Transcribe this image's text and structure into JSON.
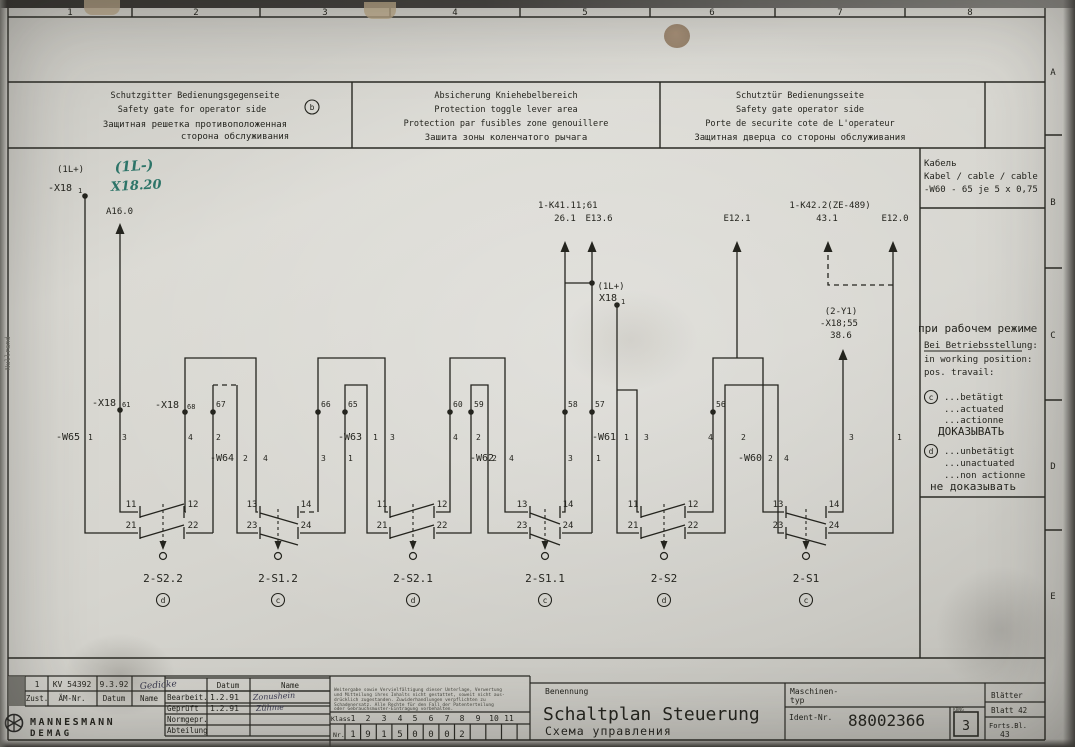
{
  "frame": {
    "ruler": [
      "1",
      "2",
      "3",
      "4",
      "5",
      "6",
      "7",
      "8"
    ],
    "rows": [
      "A",
      "B",
      "C",
      "D",
      "E"
    ],
    "margin_note": "Nullrand"
  },
  "header_boxes": [
    {
      "lines": [
        "Schutzgitter Bedienungsgegenseite",
        "Safety gate for operator side",
        "Защитная решетка противоположенная",
        "сторона обслуживания"
      ],
      "badge": "b"
    },
    {
      "lines": [
        "Absicherung Kniehebelbereich",
        "Protection toggle lever area",
        "Protection par fusibles zone genouillere",
        "Зашита зоны коленчатого рычага"
      ]
    },
    {
      "lines": [
        "Schutztür Bedienungsseite",
        "Safety gate operator side",
        "Porte de securite cote de L'operateur",
        "Защитная дверца со стороны обслуживания"
      ]
    }
  ],
  "cable_note": {
    "ru": "Кабель",
    "multi": "Kabel / cable / cable",
    "spec": "-W60 - 65 je 5 x 0,75"
  },
  "legend": {
    "title_ru": "при рабочем режиме",
    "title_de": "Bei Betriebsstellung:",
    "title_en": "in working position:",
    "title_fr": "pos. travail:",
    "c": {
      "sym": "c",
      "lines": [
        "...betätigt",
        "...actuated",
        "...actionne"
      ],
      "ru": "ДОКАЗЫВАТЬ"
    },
    "d": {
      "sym": "d",
      "lines": [
        "...unbetätigt",
        "...unactuated",
        "...non actionne"
      ],
      "ru": "не доказывать"
    }
  },
  "handwritten": {
    "l1": "(1L-)",
    "l2": "X18.20"
  },
  "sources": {
    "sup1_l1": "(1L+)",
    "sup1_l2": "-X18",
    "sup1_sub": "1",
    "a16": "A16.0",
    "k41_l1": "1-K41.11;61",
    "k41_l2": "26.1",
    "e13": "E13.6",
    "mid_l1": "(1L+)",
    "mid_l2": "X18",
    "mid_sub": "1",
    "e12_1": "E12.1",
    "k42_l1": "1-K42.2(ZE-489)",
    "k42_l2": "43.1",
    "e12_0": "E12.0",
    "y1_l1": "(2-Y1)",
    "y1_l2": "-X18;55",
    "y1_l3": "38.6"
  },
  "terminals": {
    "t61_label": "-X18",
    "t61_sub": "61",
    "t68_label": "-X18",
    "t68_sub": "68",
    "t67": "67",
    "t66": "66",
    "t65": "65",
    "t60": "60",
    "t59": "59",
    "t58": "58",
    "t57": "57",
    "t56": "56"
  },
  "cables": {
    "w65": {
      "name": "-W65",
      "c1": "1",
      "c2": "3",
      "c3": "4",
      "c4": "2"
    },
    "w64": {
      "name": "-W64",
      "c1": "2",
      "c2": "4",
      "c3": "3",
      "c4": "1"
    },
    "w63": {
      "name": "-W63",
      "c1": "1",
      "c2": "3",
      "c3": "4",
      "c4": "2"
    },
    "w62": {
      "name": "-W62",
      "c1": "2",
      "c2": "4",
      "c3": "3",
      "c4": "1"
    },
    "w61": {
      "name": "-W61",
      "c1": "1",
      "c2": "3",
      "c3": "4",
      "c4": "2"
    },
    "w60": {
      "name": "-W60",
      "c1": "2",
      "c2": "4",
      "c3": "3",
      "c4": "1"
    }
  },
  "switches": [
    {
      "name": "2-S2.2",
      "state": "d",
      "k1": "11",
      "k2": "12",
      "k3": "21",
      "k4": "22"
    },
    {
      "name": "2-S1.2",
      "state": "c",
      "k1": "13",
      "k2": "14",
      "k3": "23",
      "k4": "24"
    },
    {
      "name": "2-S2.1",
      "state": "d",
      "k1": "11",
      "k2": "12",
      "k3": "21",
      "k4": "22"
    },
    {
      "name": "2-S1.1",
      "state": "c",
      "k1": "13",
      "k2": "14",
      "k3": "23",
      "k4": "24"
    },
    {
      "name": "2-S2",
      "state": "d",
      "k1": "11",
      "k2": "12",
      "k3": "21",
      "k4": "22"
    },
    {
      "name": "2-S1",
      "state": "c",
      "k1": "13",
      "k2": "14",
      "k3": "23",
      "k4": "24"
    }
  ],
  "title_block": {
    "revision": {
      "zust": "1",
      "and_nr": "KV 54392",
      "datum": "9.3.92",
      "name": "Gedicke"
    },
    "rev_headers": {
      "zust": "Zust.",
      "and_nr": "ÄM-Nr.",
      "datum": "Datum",
      "name": "Name"
    },
    "col_datum": "Datum",
    "col_name": "Name",
    "rows": {
      "bearbeit": "Bearbeit.",
      "bearbeit_datum": "1.2.91",
      "bearbeit_name": "Zonushein",
      "gepruft": "Geprüft",
      "gepruft_datum": "1.2.91",
      "gepruft_name": "Zühme",
      "normgepr": "Normgepr.",
      "abteilung": "Abteilung"
    },
    "company_1": "MANNESMANN",
    "company_2": "DEMAG",
    "disclaimer": [
      "Weitergabe sowie Vervielfältigung dieser Unterlage, Verwertung",
      "und Mitteilung ihres Inhalts nicht gestattet, soweit nicht aus-",
      "drücklich zugestanden. Zuwiderhandlungen verpflichten zu",
      "Schadenersatz. Alle Rechte für den Fall der Patenterteilung",
      "oder Gebrauchsmuster-Eintragung vorbehalten."
    ],
    "klass_label": "Klass.",
    "klass_numbers": [
      "1",
      "2",
      "3",
      "4",
      "5",
      "6",
      "7",
      "8",
      "9",
      "10",
      "11"
    ],
    "nr_label": "Nr.",
    "nr_digits": [
      "1",
      "9",
      "1",
      "5",
      "0",
      "0",
      "0",
      "2"
    ],
    "benennung_label": "Benennung",
    "title_main": "Schaltplan Steuerung",
    "title_ru": "Схема управления",
    "maschinen_1": "Maschinen-",
    "maschinen_2": "typ",
    "ident_label": "Ident-Nr.",
    "ident_value": "88002366",
    "stamp_small": "KBNG",
    "stamp_num": "3",
    "blaetter": "Blätter",
    "blatt": "Blatt 42",
    "forts": "Forts.Bl.",
    "forts_value": "43"
  }
}
